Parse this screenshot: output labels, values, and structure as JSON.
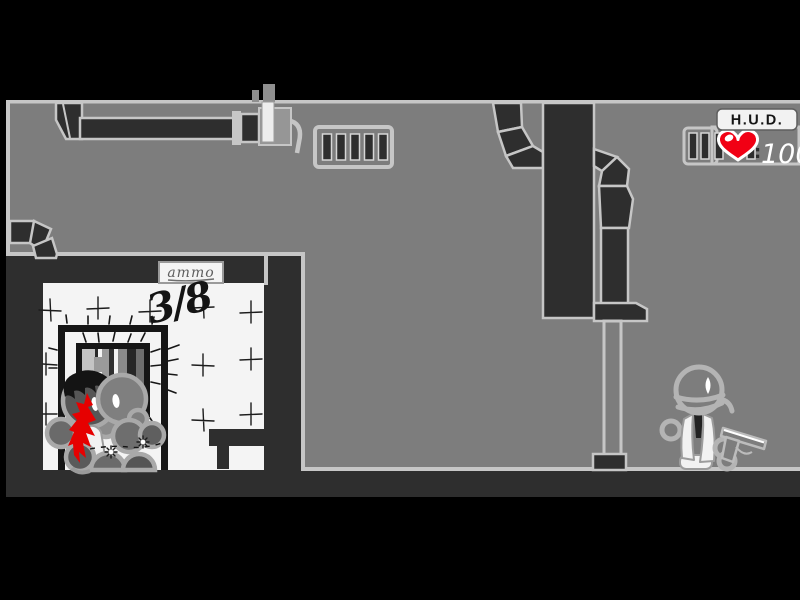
{
  "hud": {
    "title": "H.U.D.",
    "health_separator": ":",
    "health_value": "100",
    "icons": {
      "health": "heart-icon",
      "ammo": "ammo-clip-icon"
    }
  },
  "room": {
    "wall_text": "3/8",
    "sign_text": "ammo"
  },
  "colors": {
    "background": "#7d7d7d",
    "structure_dark": "#2e2e2e",
    "outline_light": "#c6c6c6",
    "room_white": "#f4f4f4",
    "blood_red": "#e60000",
    "heart_red": "#f10014"
  }
}
